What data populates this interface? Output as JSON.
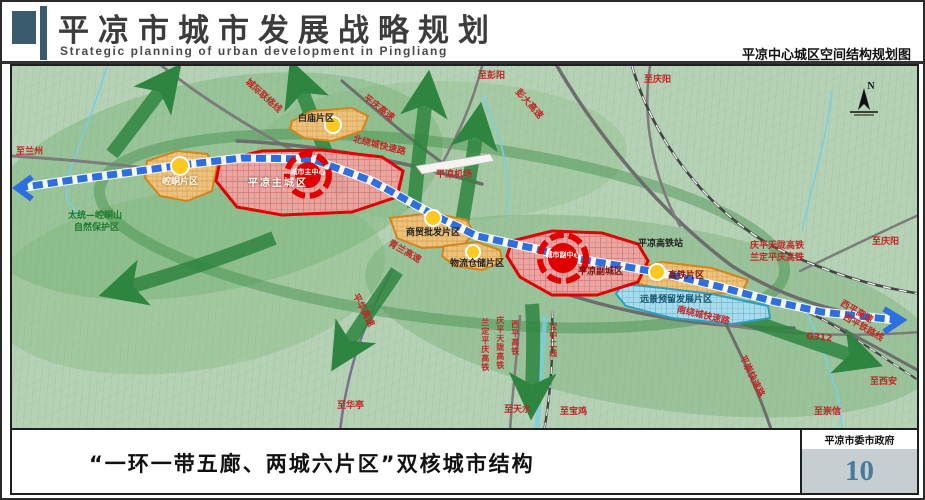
{
  "header": {
    "title": "平凉市城市发展战略规划",
    "subtitle": "Strategic planning of urban development in Pingliang",
    "map_caption": "平凉中心城区空间结构规划图"
  },
  "footer": {
    "caption": "“一环一带五廊、两城六片区”双核城市结构",
    "agency": "平凉市委市政府",
    "page_number": "10"
  },
  "map": {
    "compass": "N",
    "zones": {
      "baimiao": "白庙片区",
      "kongtong": "崆峒片区",
      "main_city": "平凉主城区",
      "main_center": "城市主中心",
      "wholesale": "商贸批发片区",
      "logistics": "物流仓储片区",
      "sub_city": "平凉副城区",
      "sub_center": "城市副中心",
      "hsr_district": "高铁片区",
      "reserved": "远景预留发展片区"
    },
    "sites": {
      "airport": "平凉机场",
      "hsr_station": "平凉高铁站"
    },
    "nature_reserve_line1": "太统—崆峒山",
    "nature_reserve_line2": "自然保护区",
    "roads": {
      "intercity": "城际联络线",
      "north_ring": "北绕城快速路",
      "south_ring": "南绕城快速路",
      "pingqing": "平庆高速",
      "pengda": "彭大高速",
      "qinglan": "青兰高速",
      "pinghua": "平华高速",
      "pingchong": "平崇快速路",
      "g312": "G312",
      "xiping_expwy": "西平高速",
      "xiping_rail": "西平铁路线",
      "qptl_hsr": "庆平天陇高铁",
      "ldpq_hsr": "兰定平庆高铁",
      "xiping_hsr": "西平高铁",
      "baozhong2": "宝中二线"
    },
    "directions": {
      "lanzhou": "至兰州",
      "pengyang": "至彭阳",
      "qingyang_top": "至庆阳",
      "qingyang_right": "至庆阳",
      "huating": "至华亭",
      "tianshui": "至天水",
      "baoji": "至宝鸡",
      "xian": "至西安",
      "chongxin": "至崇信"
    }
  }
}
